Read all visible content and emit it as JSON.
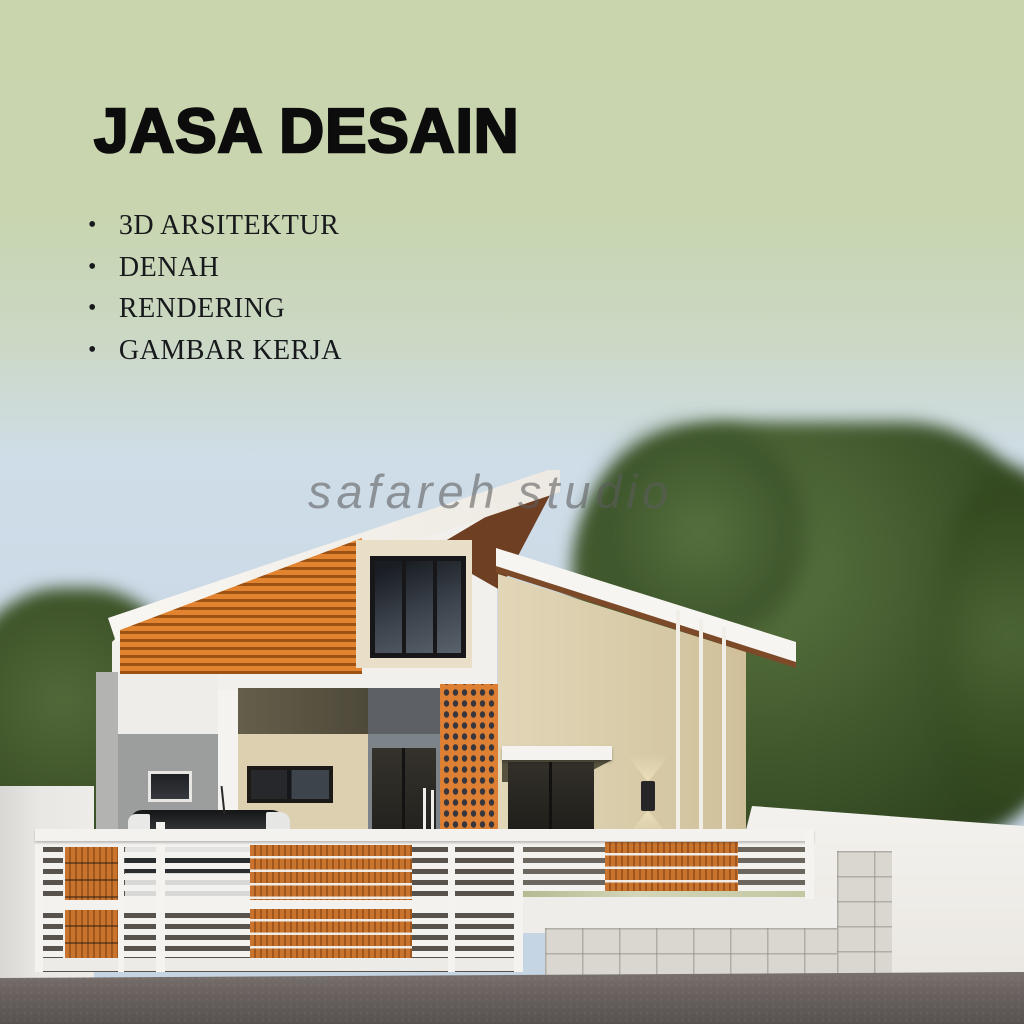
{
  "poster": {
    "title": "JASA DESAIN",
    "services": [
      "3D ARSITEKTUR",
      "DENAH",
      "RENDERING",
      "GAMBAR KERJA"
    ],
    "bullet": "•",
    "watermark": "safareh studio"
  },
  "scene": {
    "description": "3D architectural rendering of a modern single-storey house with two opposing skillion roofs, orange timber slat cladding, orange perforated ventilation-block column, white horizontal slat fence with orange wood panels, car parked behind the gate, blurred trees and a street in front",
    "colors": {
      "background_green": "#c8d5ad",
      "sky_blue": "#cfdde8",
      "title_text": "#0c0c0c",
      "cream_wall": "#d8cba8",
      "white_wall": "#f2f0ec",
      "orange_cladding": "#e2832f",
      "orange_fence_panel": "#c8742f",
      "roof_underside_brown": "#7c4a28",
      "tree_green": "#3d542b",
      "road_gray": "#6b6360",
      "watermark_gray": "#5c5c5c"
    }
  }
}
